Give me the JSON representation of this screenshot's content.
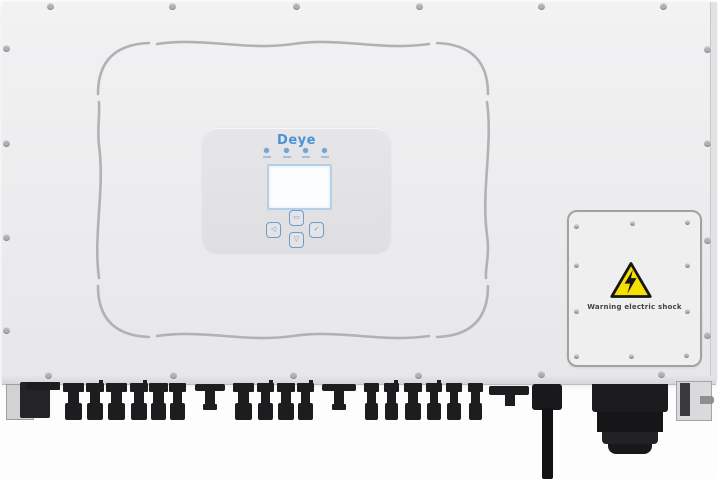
{
  "device": {
    "brand": "Deye"
  },
  "display_panel": {
    "logo_text": "Deye",
    "led_count": 4,
    "buttons": [
      {
        "id": "button-top",
        "glyph": "▭"
      },
      {
        "id": "button-left",
        "glyph": "◁"
      },
      {
        "id": "button-right",
        "glyph": "✓"
      },
      {
        "id": "button-bottom",
        "glyph": "▽"
      }
    ]
  },
  "warning_label": {
    "text": "Warning electric shock",
    "icon": "high-voltage-triangle"
  },
  "colors": {
    "body_gray": "#ececee",
    "logo_blue": "#4a92d8",
    "panel_blue": "#6d9ccd",
    "warning_yellow": "#f6e000",
    "connector_black": "#1d1d1f"
  }
}
